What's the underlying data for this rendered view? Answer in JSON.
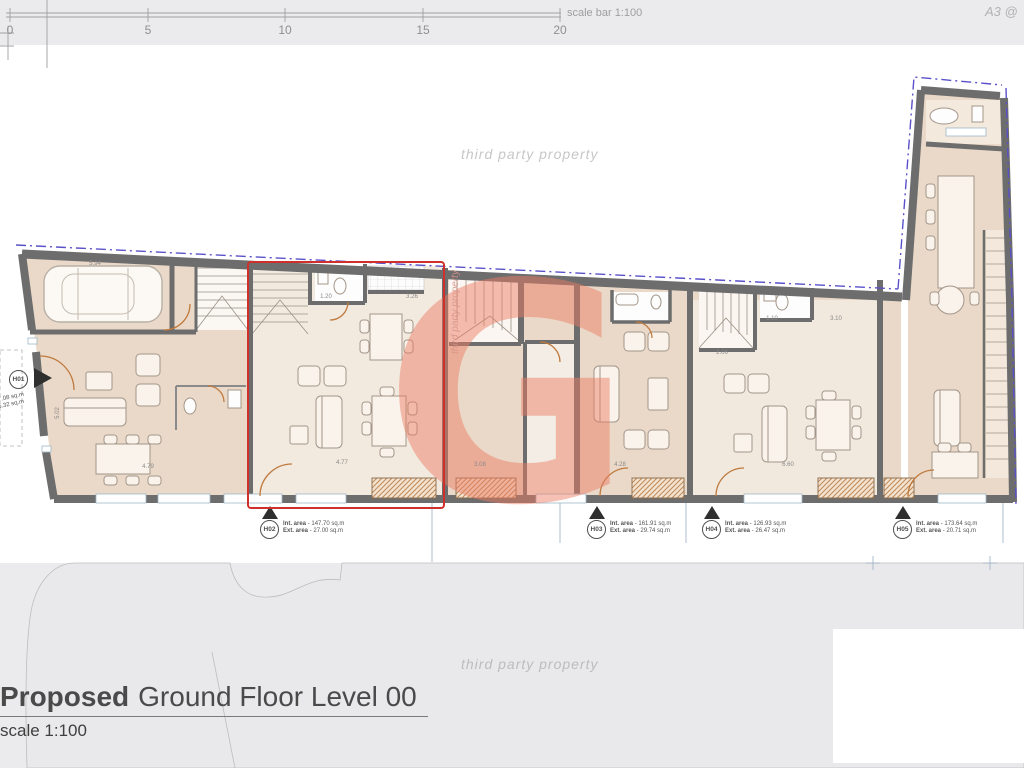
{
  "topbar": {
    "ruler_ticks": [
      "0",
      "5",
      "10",
      "15",
      "20"
    ],
    "scale_bar_label": "scale bar 1:100",
    "sheet_size_note": "A3 @"
  },
  "watermarks": {
    "text": "third party property",
    "logo_letter": "G",
    "logo_color": "#ec7c63"
  },
  "units": [
    {
      "id": "H01",
      "int_label": "Int. area",
      "int_value": "- 107.08 sq.m",
      "ext_label": "Ext. area",
      "ext_value": "- 15.32 sq.m"
    },
    {
      "id": "H02",
      "int_label": "Int. area",
      "int_value": "- 147.70 sq.m",
      "ext_label": "Ext. area",
      "ext_value": "- 27.00 sq.m",
      "highlight_color": "#d0302b"
    },
    {
      "id": "H03",
      "int_label": "Int. area",
      "int_value": "- 161.91 sq.m",
      "ext_label": "Ext. area",
      "ext_value": "- 29.74 sq.m"
    },
    {
      "id": "H04",
      "int_label": "Int. area",
      "int_value": "- 126.93 sq.m",
      "ext_label": "Ext. area",
      "ext_value": "- 26.47 sq.m"
    },
    {
      "id": "H05",
      "int_label": "Int. area",
      "int_value": "- 173.64 sq.m",
      "ext_label": "Ext. area",
      "ext_value": "- 20.71 sq.m"
    }
  ],
  "dimensions": [
    "5.94",
    "4.79",
    "4.28",
    "6.60",
    "2.06",
    "3.10",
    "1.10",
    "4.77",
    "3.26",
    "1.20",
    "3.08",
    "5.02"
  ],
  "title_block": {
    "title_bold": "Proposed",
    "title_rest": "Ground Floor Level 00",
    "scale_note": "scale 1:100"
  },
  "colors": {
    "background": "#ebebed",
    "sheet": "#ffffff",
    "wall": "#6d6d6d",
    "room": "#ead9c8",
    "room_light": "#f2e9df",
    "accent_red": "#d0302b",
    "site_boundary": "#5a51c9",
    "door": "#bf7a3e",
    "hatch": "#c08a58"
  }
}
